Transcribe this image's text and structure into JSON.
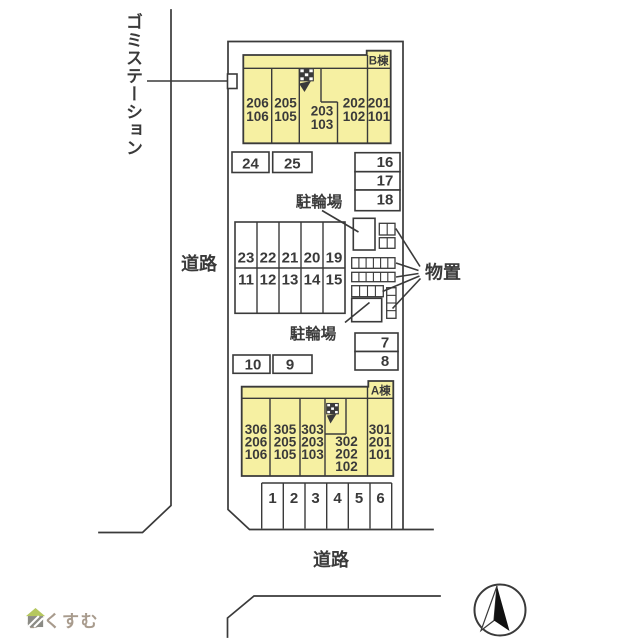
{
  "colors": {
    "line": "#3a3a3a",
    "building_fill": "#f6f0a2",
    "background": "#ffffff",
    "logo_text": "#a89b8d",
    "logo_roof": "#b5c75f",
    "logo_body": "#8b8b85"
  },
  "labels": {
    "garbage_station": "ゴミステーション",
    "road_left": "道路",
    "road_bottom": "道路",
    "bike_parking_top": "駐輪場",
    "bike_parking_bottom": "駐輪場",
    "storage": "物置",
    "logo": "らくすむ"
  },
  "building_b": {
    "name": "B棟",
    "units": [
      {
        "lines": [
          "206",
          "106"
        ]
      },
      {
        "lines": [
          "205",
          "105"
        ]
      },
      {
        "lines": [
          "203",
          "103"
        ]
      },
      {
        "lines": [
          "202",
          "102"
        ]
      },
      {
        "lines": [
          "201",
          "101"
        ]
      }
    ]
  },
  "building_a": {
    "name": "A棟",
    "units": [
      {
        "lines": [
          "306",
          "206",
          "106"
        ]
      },
      {
        "lines": [
          "305",
          "205",
          "105"
        ]
      },
      {
        "lines": [
          "303",
          "203",
          "103"
        ]
      },
      {
        "lines": [
          "302",
          "202",
          "102"
        ]
      },
      {
        "lines": [
          "301",
          "201",
          "101"
        ]
      }
    ]
  },
  "parking": {
    "pair_top": [
      "24",
      "25"
    ],
    "right_top": [
      "16",
      "17",
      "18"
    ],
    "grid_upper": [
      "23",
      "22",
      "21",
      "20",
      "19"
    ],
    "grid_lower": [
      "11",
      "12",
      "13",
      "14",
      "15"
    ],
    "right_mid": [
      "7",
      "8"
    ],
    "pair_mid": [
      "10",
      "9"
    ],
    "bottom_row": [
      "1",
      "2",
      "3",
      "4",
      "5",
      "6"
    ]
  }
}
